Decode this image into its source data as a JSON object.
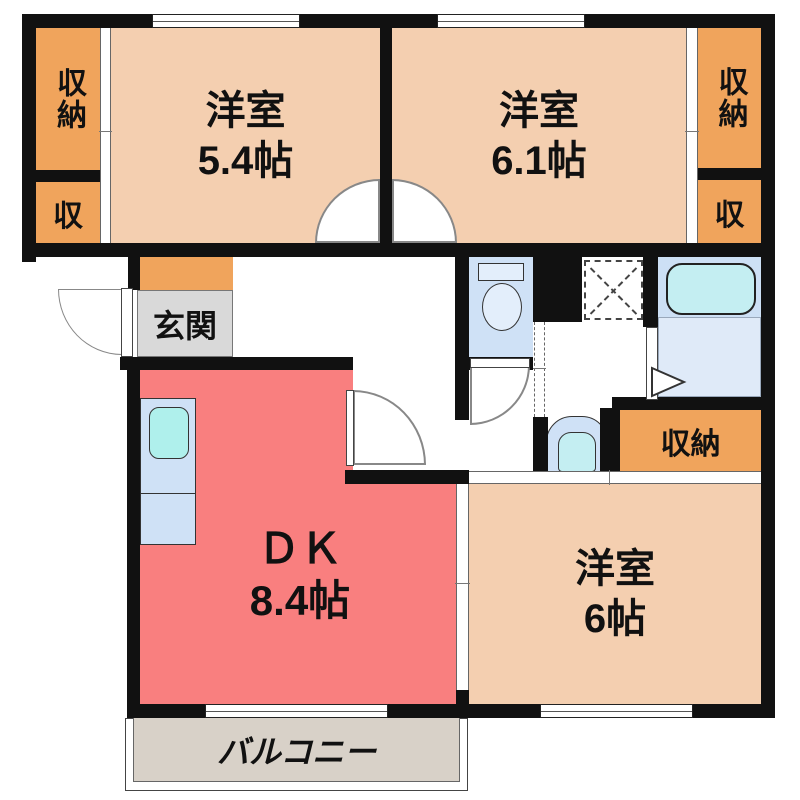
{
  "rooms": {
    "western_room_1": {
      "name": "洋室",
      "size": "5.4帖"
    },
    "western_room_2": {
      "name": "洋室",
      "size": "6.1帖"
    },
    "western_room_3": {
      "name": "洋室",
      "size": "6帖"
    },
    "dk": {
      "name": "ＤＫ",
      "size": "8.4帖"
    },
    "entrance": {
      "name": "玄関"
    },
    "balcony": {
      "name": "バルコニー"
    }
  },
  "closets": {
    "top_left": {
      "label": "収納"
    },
    "top_left_small": {
      "label": "収"
    },
    "top_right": {
      "label": "収納"
    },
    "top_right_small": {
      "label": "収"
    },
    "bottom_right": {
      "label": "収納"
    }
  },
  "colors": {
    "wall": "#111111",
    "room-peach": "#f4cfb0",
    "closet-orange": "#f0a45c",
    "dk-red": "#f97f7f",
    "entrance-gray": "#d9d9d9",
    "water-blue": "#cfe1f6",
    "bath-upper": "#cde0f5",
    "bath-lower": "#dfeaf8",
    "tub-cyan": "#c4eef2",
    "sink-cyan": "#aff0ec",
    "balcony-beige": "#d8d1c8"
  }
}
